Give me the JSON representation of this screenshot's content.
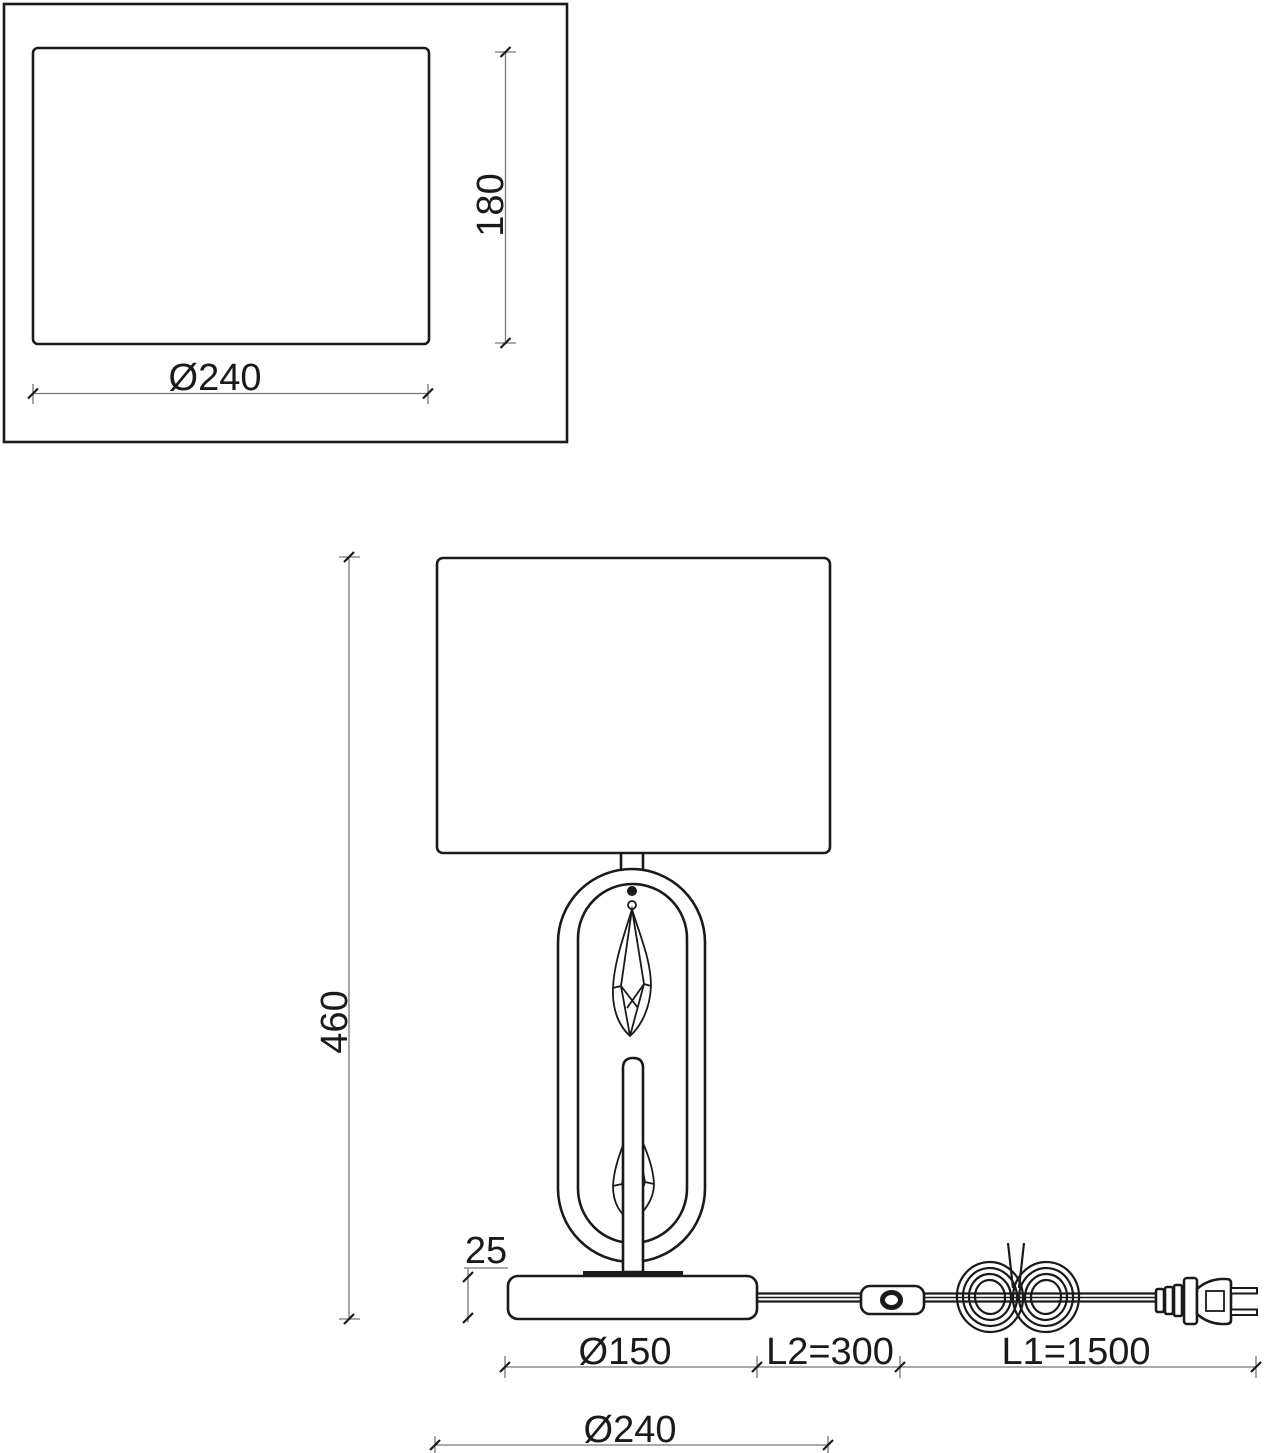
{
  "top_view": {
    "diameter_label": "Ø240",
    "depth_label": "180"
  },
  "front_view": {
    "height_label": "460",
    "base_height_label": "25",
    "base_diameter_label": "Ø150",
    "switch_distance_label": "L2=300",
    "cord_length_label": "L1=1500",
    "shade_diameter_label": "Ø240"
  },
  "colors": {
    "line": "#1a1a1a",
    "dimension_line": "#777777",
    "background": "#ffffff"
  }
}
